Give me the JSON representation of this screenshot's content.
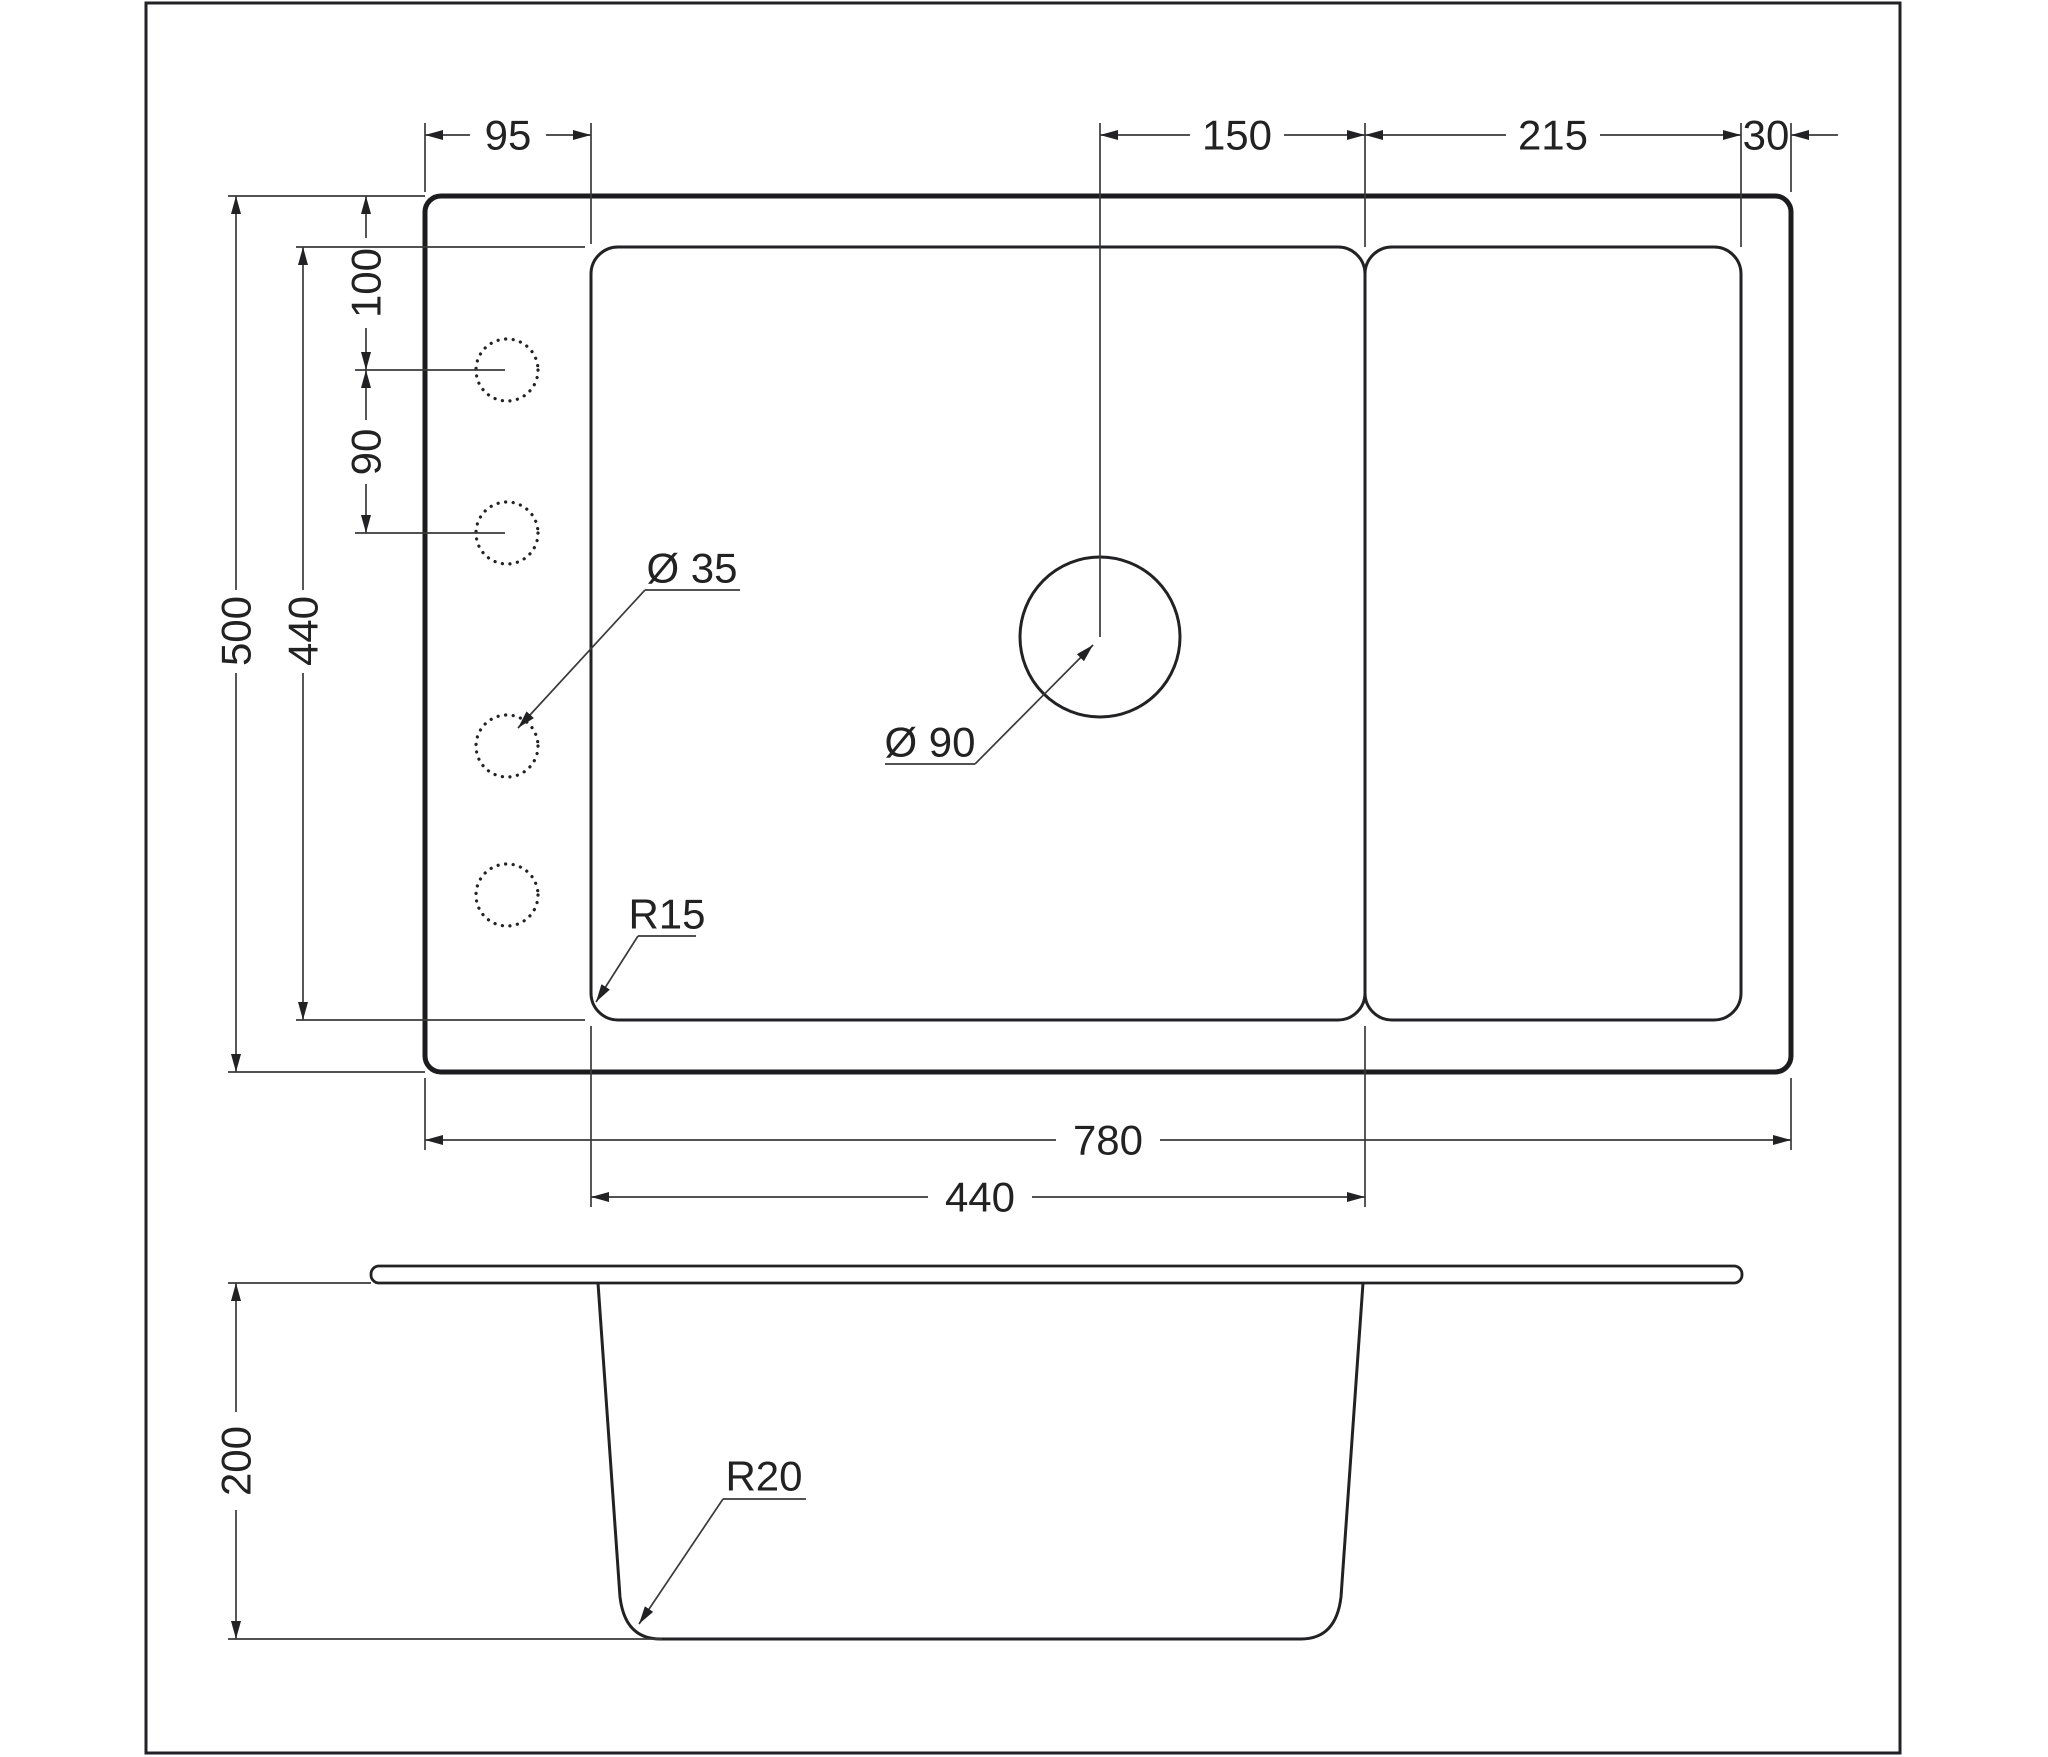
{
  "drawing": {
    "kind": "sink-technical-drawing",
    "colors": {
      "line": "#222222",
      "accent_blue": "#3a76a8",
      "background": "#ffffff"
    },
    "plan_view": {
      "top_dimensions": {
        "left_offset": {
          "label": "95"
        },
        "drain_to_bowl_edge": {
          "label": "150"
        },
        "drainer_width": {
          "label": "215"
        },
        "right_margin": {
          "label": "30"
        }
      },
      "left_dimensions": {
        "overall_depth": {
          "label": "500"
        },
        "bowl_depth": {
          "label": "440"
        },
        "hole_top_offset": {
          "label": "100"
        },
        "hole_spacing": {
          "label": "90"
        }
      },
      "bottom_dimensions": {
        "overall_width": {
          "label": "780"
        },
        "bowl_width": {
          "label": "440"
        }
      },
      "callouts": {
        "tap_hole_diameter": {
          "label": "Ø 35"
        },
        "drain_diameter": {
          "label": "Ø 90"
        },
        "bowl_corner_radius": {
          "label": "R15"
        }
      }
    },
    "section_view": {
      "dimensions": {
        "bowl_height": {
          "label": "200"
        }
      },
      "callouts": {
        "bottom_corner_radius": {
          "label": "R20"
        }
      }
    }
  }
}
